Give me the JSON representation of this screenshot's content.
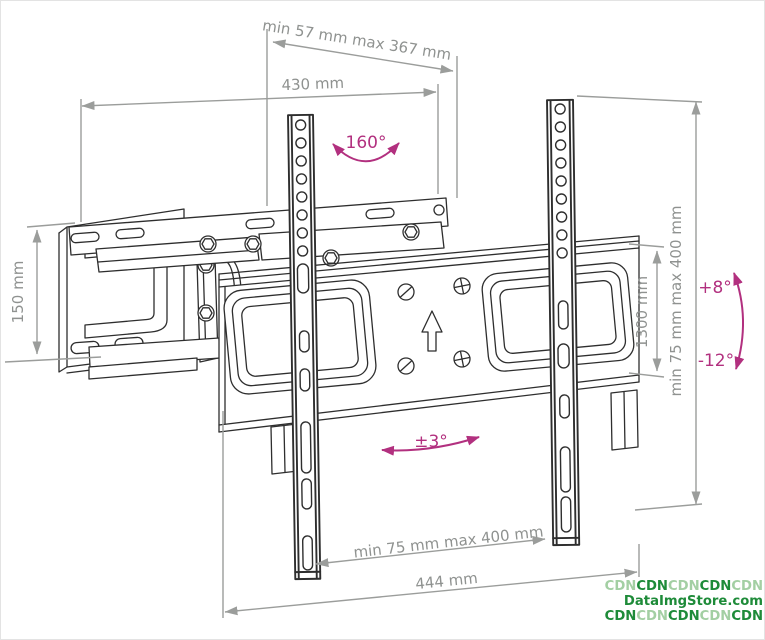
{
  "diagram": {
    "title": "Articulating TV wall mount bracket technical drawing",
    "dimensions": {
      "extension_depth": "min 57 mm max 367 mm",
      "top_width": "430 mm",
      "wall_plate_height": "150 mm",
      "right_height_range": "min 75 mm max 400 mm",
      "plate_right_height": "1300 mm",
      "rail_spacing_range": "min 75 mm max 400 mm",
      "bottom_width": "444 mm"
    },
    "angles": {
      "swivel_range": "160°",
      "tilt_up": "+8°",
      "tilt_down": "-12°",
      "level_adjust": "±3°"
    },
    "colors": {
      "line_art": "#2e2e2e",
      "dimension": "#9b9d9b",
      "angle_accent": "#b2307f",
      "watermark_dark": "#1e8b39",
      "watermark_light": "#a3cfa3",
      "background": "#ffffff"
    }
  },
  "watermark": {
    "line1": [
      "CDN",
      "CDN",
      "CDN",
      "CDN",
      "CDN"
    ],
    "line2": "DataImgStore.com",
    "line3": [
      "CDN",
      "CDN",
      "CDN",
      "CDN",
      "CDN"
    ]
  }
}
